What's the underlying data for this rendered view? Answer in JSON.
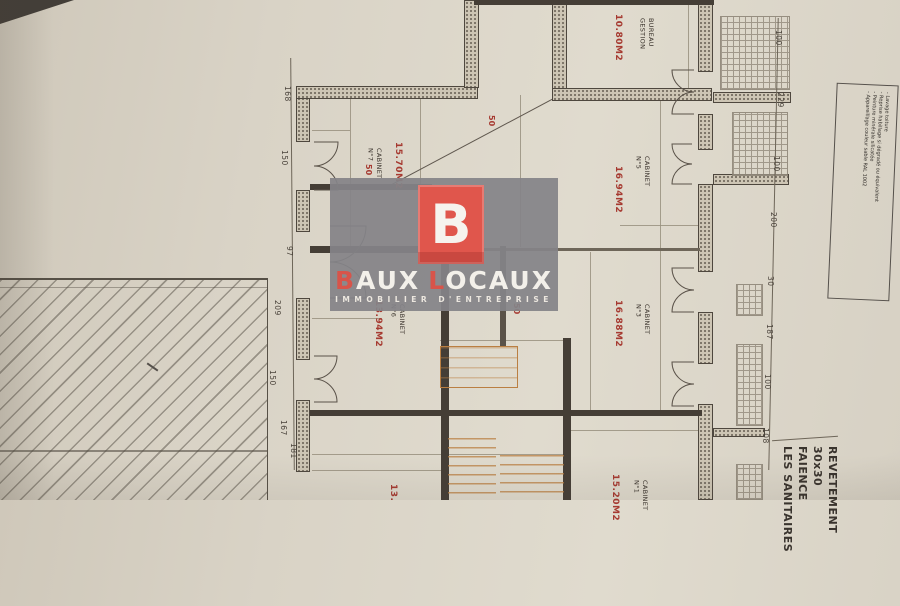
{
  "watermark": {
    "logo_letter": "B",
    "brand": {
      "part1_red": "B",
      "part1_white": "AUX",
      "part2_red": "L",
      "part2_white": "OCAUX"
    },
    "tagline": "IMMOBILIER D'ENTREPRISE",
    "colors": {
      "panel_gray": "#85848a",
      "logo_red": "#e0564c",
      "accent_red": "#d8544a"
    }
  },
  "rooms": {
    "bureau_gestion": {
      "name_line1": "BUREAU",
      "name_line2": "GESTION",
      "area": "10.80M2"
    },
    "cabinet7": {
      "name_line1": "CABINET",
      "name_line2": "N°7",
      "area": "15.70M2"
    },
    "cabinet6": {
      "name_line1": "CABINET",
      "name_line2": "N°6",
      "area": "13.94M2"
    },
    "cabinet5": {
      "name_line1": "CABINET",
      "name_line2": "N°5",
      "area": "16.94M2"
    },
    "cabinet3": {
      "name_line1": "CABINET",
      "name_line2": "N°3",
      "area": "16.88M2"
    },
    "cabinet1": {
      "name_line1": "CABINET",
      "name_line2": "N°1",
      "area": "15.20M2"
    },
    "cabinet_partial": {
      "area": "13."
    }
  },
  "dimensions": {
    "right_chain": [
      "100",
      "229",
      "100",
      "200",
      "30",
      "187",
      "100",
      "108"
    ],
    "left_chain": [
      "168",
      "150",
      "97",
      "209",
      "150",
      "167",
      "181"
    ],
    "red_marks": [
      "50",
      "50",
      "50"
    ]
  },
  "legend_block": {
    "lines": [
      "REVETEMENT",
      "30x30",
      "FAIENCE",
      "LES SANITAIRES"
    ]
  },
  "notes_box": {
    "lines": [
      "- Lavage toiture",
      "- Reprise habillage si dégradé ou équivalent",
      "- Peinture minérale silicatée",
      "- Appareillage couleur sable RAL 1002"
    ]
  },
  "plan_colors": {
    "paper": "#dcd6c9",
    "wall_dark": "#453e36",
    "area_red": "#a63a31",
    "stair_orange": "#ba7f42",
    "tile_gray": "#968e80"
  }
}
